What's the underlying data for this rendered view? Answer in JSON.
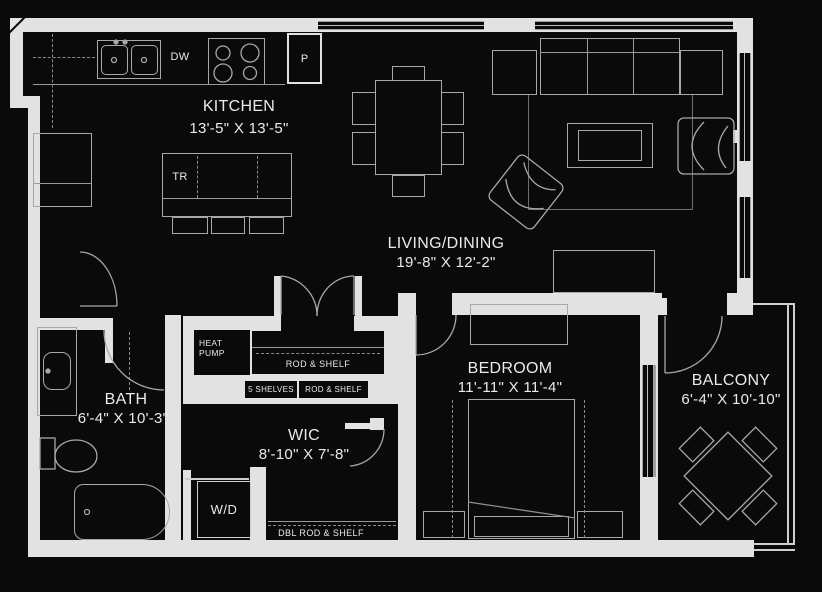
{
  "plan": {
    "rooms": [
      {
        "id": "kitchen",
        "name": "KITCHEN",
        "dims": "13'-5\" X 13'-5\""
      },
      {
        "id": "living_dining",
        "name": "LIVING/DINING",
        "dims": "19'-8\" X 12'-2\""
      },
      {
        "id": "bedroom",
        "name": "BEDROOM",
        "dims": "11'-11\" X 11'-4\""
      },
      {
        "id": "balcony",
        "name": "BALCONY",
        "dims": "6'-4\" X 10'-10\""
      },
      {
        "id": "bath",
        "name": "BATH",
        "dims": "6'-4\" X 10'-3\""
      },
      {
        "id": "wic",
        "name": "WIC",
        "dims": "8'-10\" X 7'-8\""
      }
    ],
    "labels": {
      "dishwasher": "DW",
      "pantry": "P",
      "trash": "TR",
      "washer_dryer": "W/D",
      "heat_pump": "HEAT PUMP",
      "rod_shelf_closet": "ROD & SHELF",
      "shelves": "5 SHELVES",
      "rod_shelf_wic": "ROD & SHELF",
      "dbl_rod_shelf": "DBL ROD & SHELF"
    },
    "colors": {
      "background": "#0a0a0a",
      "wall": "#e2e2e2",
      "furniture_line": "#a8a8a8",
      "text": "#eaeaea"
    }
  }
}
